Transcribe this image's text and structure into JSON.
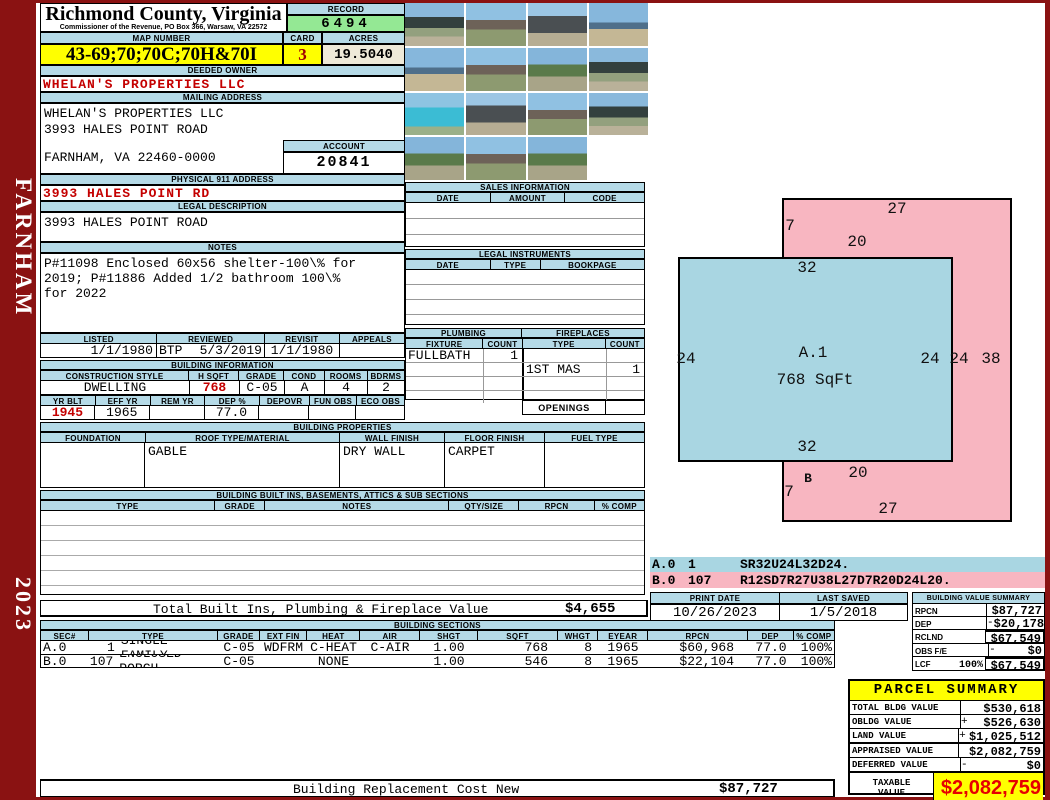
{
  "county": {
    "title": "Richmond County, Virginia",
    "subtitle": "Commissioner of the Revenue, PO Box 366, Warsaw, VA 22572"
  },
  "sidebar": {
    "district": "FARNHAM",
    "year": "2023"
  },
  "record": {
    "label": "RECORD",
    "value": "6494"
  },
  "map": {
    "label": "MAP NUMBER",
    "value": "43-69;70;70C;70H&70I"
  },
  "card": {
    "label": "CARD",
    "value": "3"
  },
  "acres": {
    "label": "ACRES",
    "value": "19.5040"
  },
  "owner": {
    "label": "DEEDED OWNER",
    "value": "WHELAN'S PROPERTIES LLC"
  },
  "mailing": {
    "label": "MAILING ADDRESS",
    "line1": "WHELAN'S PROPERTIES LLC",
    "line2": "3993 HALES POINT ROAD",
    "line3": "FARNHAM, VA 22460-0000"
  },
  "account": {
    "label": "ACCOUNT",
    "value": "20841"
  },
  "physical": {
    "label": "PHYSICAL 911 ADDRESS",
    "value": "3993 HALES POINT RD"
  },
  "legal_description": {
    "label": "LEGAL DESCRIPTION",
    "value": "3993 HALES POINT ROAD"
  },
  "notes": {
    "label": "NOTES",
    "lines": [
      "P#11098 Enclosed 60x56 shelter-100\\% for",
      "2019; P#11886 Added 1/2 bathroom 100\\%",
      "for 2022"
    ]
  },
  "review": {
    "listed_label": "LISTED",
    "reviewed_label": "REVIEWED",
    "revisit_label": "REVISIT",
    "appeals_label": "APPEALS",
    "listed": "1/1/1980",
    "reviewed_by": "BTP",
    "reviewed_date": "5/3/2019",
    "revisit": "1/1/1980",
    "appeals": ""
  },
  "building_info": {
    "title": "BUILDING INFORMATION",
    "headers1": [
      "CONSTRUCTION STYLE",
      "H SQFT",
      "GRADE",
      "COND",
      "ROOMS",
      "BDRMS"
    ],
    "values1": [
      "DWELLING",
      "768",
      "C-05",
      "A",
      "4",
      "2"
    ],
    "headers2": [
      "YR BLT",
      "EFF YR",
      "REM YR",
      "DEP %",
      "DEPOVR",
      "FUN OBS",
      "ECO OBS"
    ],
    "values2": [
      "1945",
      "1965",
      "",
      "77.0",
      "",
      "",
      ""
    ]
  },
  "sales": {
    "title": "SALES INFORMATION",
    "headers": [
      "DATE",
      "AMOUNT",
      "CODE"
    ]
  },
  "instruments": {
    "title": "LEGAL INSTRUMENTS",
    "headers": [
      "DATE",
      "TYPE",
      "BOOKPAGE"
    ]
  },
  "plumbing": {
    "title": "PLUMBING",
    "fixture_label": "FIXTURE",
    "count_label": "COUNT",
    "row1": {
      "fixture": "FULLBATH",
      "count": "1"
    }
  },
  "fireplaces": {
    "title": "FIREPLACES",
    "type_label": "TYPE",
    "count_label": "COUNT",
    "row2": {
      "type": "1ST MAS",
      "count": "1"
    },
    "openings_label": "OPENINGS",
    "openings_value": ""
  },
  "properties": {
    "title": "BUILDING PROPERTIES",
    "headers": [
      "FOUNDATION",
      "ROOF TYPE/MATERIAL",
      "WALL FINISH",
      "FLOOR FINISH",
      "FUEL TYPE"
    ],
    "foundation": "",
    "roof": "GABLE",
    "wall": "DRY WALL",
    "floor": "CARPET",
    "fuel": ""
  },
  "built_ins": {
    "title": "BUILDING BUILT INS, BASEMENTS, ATTICS & SUB SECTIONS",
    "headers": [
      "TYPE",
      "GRADE",
      "NOTES",
      "QTY/SIZE",
      "RPCN",
      "% COMP"
    ],
    "total_label": "Total Built Ins, Plumbing & Fireplace Value",
    "total_value": "$4,655"
  },
  "sections": {
    "title": "BUILDING SECTIONS",
    "headers": [
      "SEC#",
      "TYPE",
      "GRADE",
      "EXT FIN",
      "HEAT",
      "AIR",
      "SHGT",
      "SQFT",
      "WHGT",
      "EYEAR",
      "RPCN",
      "DEP",
      "% COMP"
    ],
    "rows": [
      {
        "sec": "A.0",
        "num": "1",
        "type": "SINGLE FAMILY",
        "grade": "C-05",
        "ext_fin": "WDFRM",
        "heat": "C-HEAT",
        "air": "C-AIR",
        "shgt": "1.00",
        "sqft": "768",
        "whgt": "8",
        "eyear": "1965",
        "rpcn": "$60,968",
        "dep": "77.0",
        "comp": "100%"
      },
      {
        "sec": "B.0",
        "num": "107",
        "type": "ENCLOSED PORCH",
        "grade": "C-05",
        "ext_fin": "",
        "heat": "NONE",
        "air": "",
        "shgt": "1.00",
        "sqft": "546",
        "whgt": "8",
        "eyear": "1965",
        "rpcn": "$22,104",
        "dep": "77.0",
        "comp": "100%"
      }
    ]
  },
  "sketch": {
    "section_a": {
      "name": "A.1",
      "sqft": "768 SqFt"
    },
    "section_b": {
      "name": "B"
    },
    "labels": [
      "27",
      "7",
      "20",
      "32",
      "24",
      "24",
      "24",
      "38",
      "32",
      "20",
      "7",
      "27"
    ]
  },
  "vectors": [
    {
      "sec": "A.0",
      "num": "1",
      "path": "SR32U24L32D24."
    },
    {
      "sec": "B.0",
      "num": "107",
      "path": "R12SD7R27U38L27D7R20D24L20."
    }
  ],
  "print": {
    "print_date_label": "PRINT DATE",
    "print_date": "10/26/2023",
    "last_saved_label": "LAST SAVED",
    "last_saved": "1/5/2018"
  },
  "value_summary": {
    "title": "BUILDING VALUE SUMMARY",
    "rows": [
      {
        "label": "RPCN",
        "pct": "",
        "op": "",
        "value": "$87,727"
      },
      {
        "label": "DEP",
        "pct": "",
        "op": "-",
        "value": "$20,178"
      },
      {
        "label": "RCLND",
        "pct": "",
        "op": "",
        "value": "$67,549"
      },
      {
        "label": "OBS F/E",
        "pct": "",
        "op": "-",
        "value": "$0"
      },
      {
        "label": "LCF",
        "pct": "100%",
        "op": "",
        "value": "$67,549"
      }
    ]
  },
  "parcel_summary": {
    "title": "PARCEL SUMMARY",
    "rows": [
      {
        "label": "TOTAL BLDG VALUE",
        "op": "",
        "value": "$530,618"
      },
      {
        "label": "OBLDG VALUE",
        "op": "+",
        "value": "$526,630"
      },
      {
        "label": "LAND VALUE",
        "op": "+",
        "value": "$1,025,512"
      },
      {
        "label": "APPRAISED VALUE",
        "op": "",
        "value": "$2,082,759"
      },
      {
        "label": "DEFERRED VALUE",
        "op": "-",
        "value": "$0"
      }
    ],
    "taxable_label_line1": "TAXABLE",
    "taxable_label_line2": "VALUE",
    "taxable_value": "$2,082,759"
  },
  "footer": {
    "label": "Building Replacement Cost New",
    "value": "$87,727"
  },
  "photo_grid": {
    "count": 15
  },
  "colors": {
    "header_blue": "#b5dae7",
    "record_green": "#94e894",
    "highlight_yellow": "#ffff00",
    "acres_cream": "#eee9d8",
    "sketch_pink": "#f8b6c1",
    "sketch_blue": "#a9d6e2",
    "sidebar_maroon": "#8a1212",
    "accent_red": "#c40000",
    "taxable_red": "#e60000"
  }
}
